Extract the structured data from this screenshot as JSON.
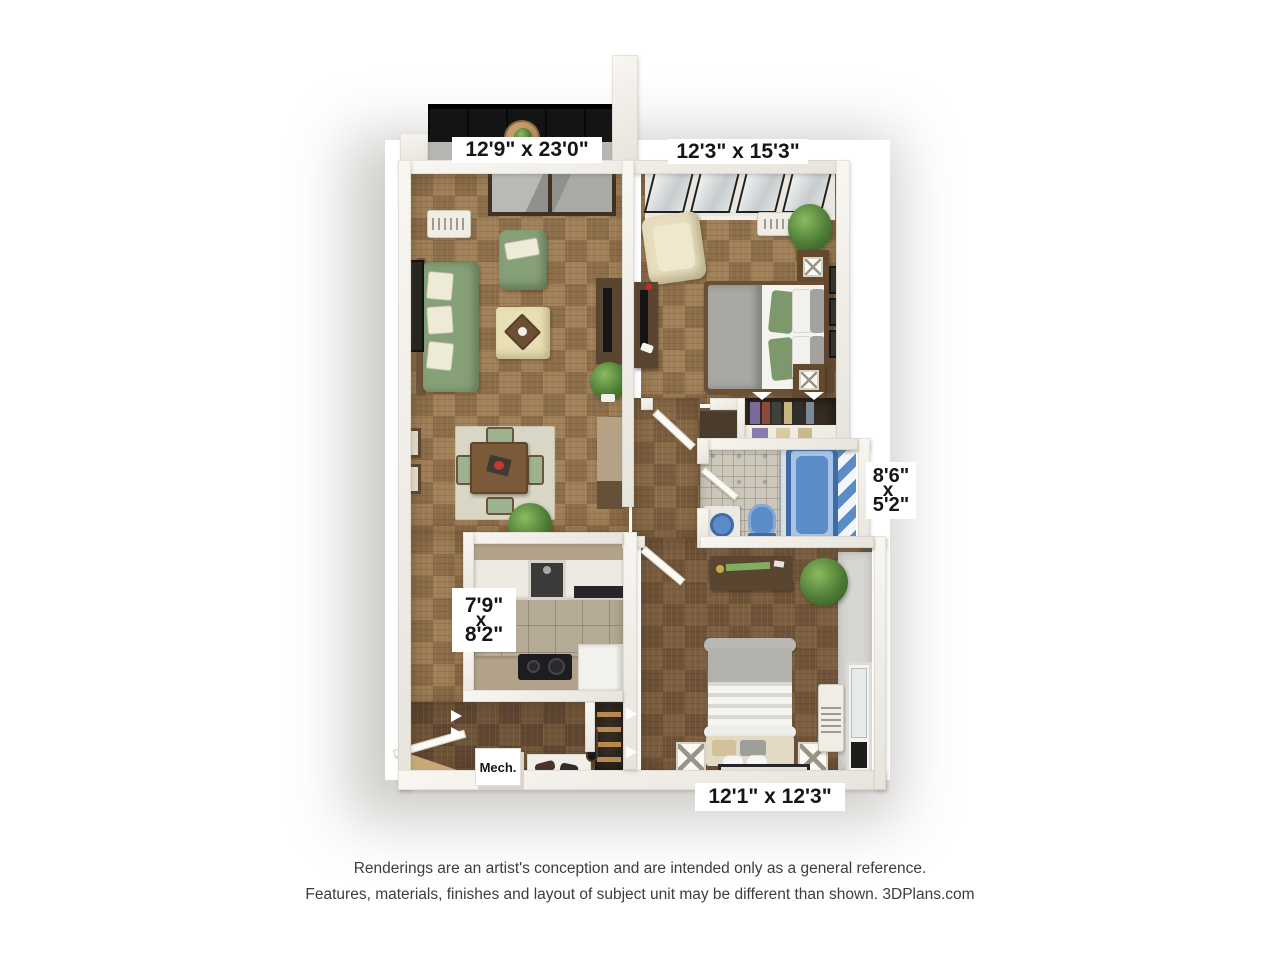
{
  "dimensions": {
    "living_room": "12'9\" x 23'0\"",
    "bedroom_1": "12'3\" x 15'3\"",
    "bathroom": {
      "w": "8'6\"",
      "x": "x",
      "l": "5'2\""
    },
    "kitchen": {
      "w": "7'9\"",
      "x": "x",
      "l": "8'2\""
    },
    "bedroom_2": "12'1\" x 12'3\"",
    "mechanical": "Mech."
  },
  "footer": {
    "line1": "Renderings are an artist's conception and are intended only as a general reference.",
    "line2": "Features, materials, finishes and layout of subject unit may be different than shown. 3DPlans.com"
  },
  "colors": {
    "label_bg": "#ffffff",
    "label_text": "#161616",
    "footer_text": "#3d3d3d",
    "wall": "#f3f1ec",
    "floor_light_a": "#a08159",
    "floor_light_b": "#8d6e4a",
    "floor_dark_a": "#6f5539",
    "floor_dark_b": "#5f4732",
    "floor_mid_a": "#8a6b48",
    "floor_mid_b": "#7a5d3e",
    "bedroom2_floor_a": "#7d5f41",
    "bedroom2_floor_b": "#6e5338",
    "fixture_blue": "#5b8cc8",
    "fixture_blue_dark": "#3f6ba6",
    "sofa_green": "#86a078",
    "pillow_green": "#7d996c",
    "wood_dark": "#5a4531",
    "wood_mid": "#7b5a39",
    "cream": "#e8dfb4",
    "balcony_floor": "#141414"
  }
}
